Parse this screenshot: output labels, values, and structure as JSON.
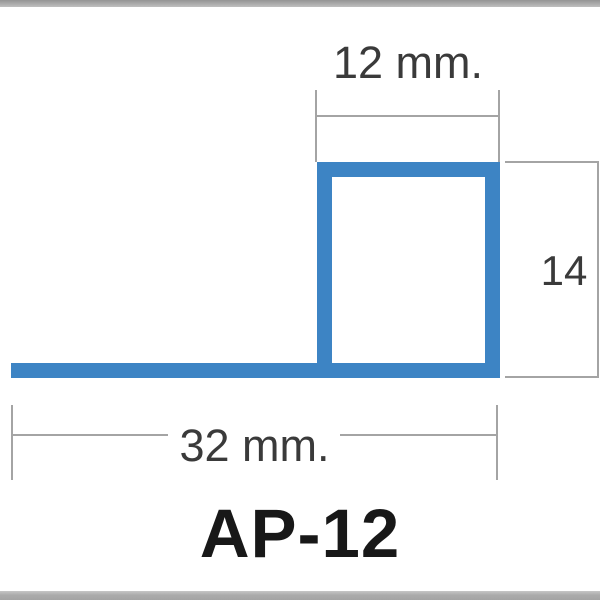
{
  "colors": {
    "profile_blue": "#3d84c4",
    "dimension_line_gray": "#a4a4a4",
    "dimension_text_gray": "#3a3a3a",
    "title_black": "#181818",
    "frame_bar_gray": "#ababab",
    "background": "#ffffff"
  },
  "diagram": {
    "dimensions": {
      "top_width": {
        "label": "12 mm.",
        "value": 12,
        "unit": "mm"
      },
      "right_height": {
        "label": "14",
        "value": 14,
        "unit": "mm"
      },
      "bottom_width": {
        "label": "32 mm.",
        "value": 32,
        "unit": "mm"
      }
    },
    "product": {
      "code": "AP-12"
    }
  }
}
